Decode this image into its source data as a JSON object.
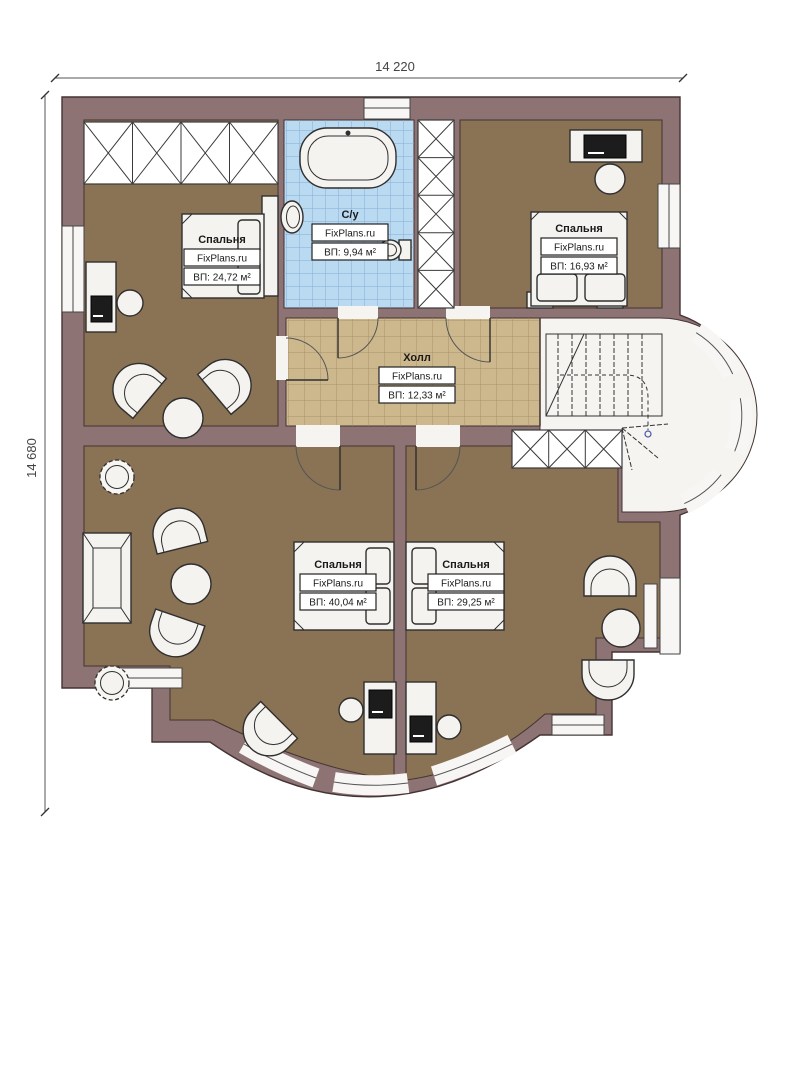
{
  "plan": {
    "dimensions": {
      "width_label": "14 220",
      "height_label": "14 680"
    },
    "rooms": [
      {
        "id": "bedroom-top-left",
        "name": "Спальня",
        "brand": "FixPlans.ru",
        "area": "ВП: 24,72 м²"
      },
      {
        "id": "bathroom",
        "name": "С/у",
        "brand": "FixPlans.ru",
        "area": "ВП: 9,94 м²"
      },
      {
        "id": "bedroom-top-right",
        "name": "Спальня",
        "brand": "FixPlans.ru",
        "area": "ВП: 16,93 м²"
      },
      {
        "id": "hall",
        "name": "Холл",
        "brand": "FixPlans.ru",
        "area": "ВП: 12,33 м²"
      },
      {
        "id": "bedroom-bottom-left",
        "name": "Спальня",
        "brand": "FixPlans.ru",
        "area": "ВП: 40,04 м²"
      },
      {
        "id": "bedroom-bottom-right",
        "name": "Спальня",
        "brand": "FixPlans.ru",
        "area": "ВП: 29,25 м²"
      }
    ],
    "colors": {
      "wall": "#8d7373",
      "room_floor": "#8a7254",
      "hall_floor": "#cdb88e",
      "bath_floor": "#badaf2",
      "white_floor": "#f5f4f1"
    }
  }
}
